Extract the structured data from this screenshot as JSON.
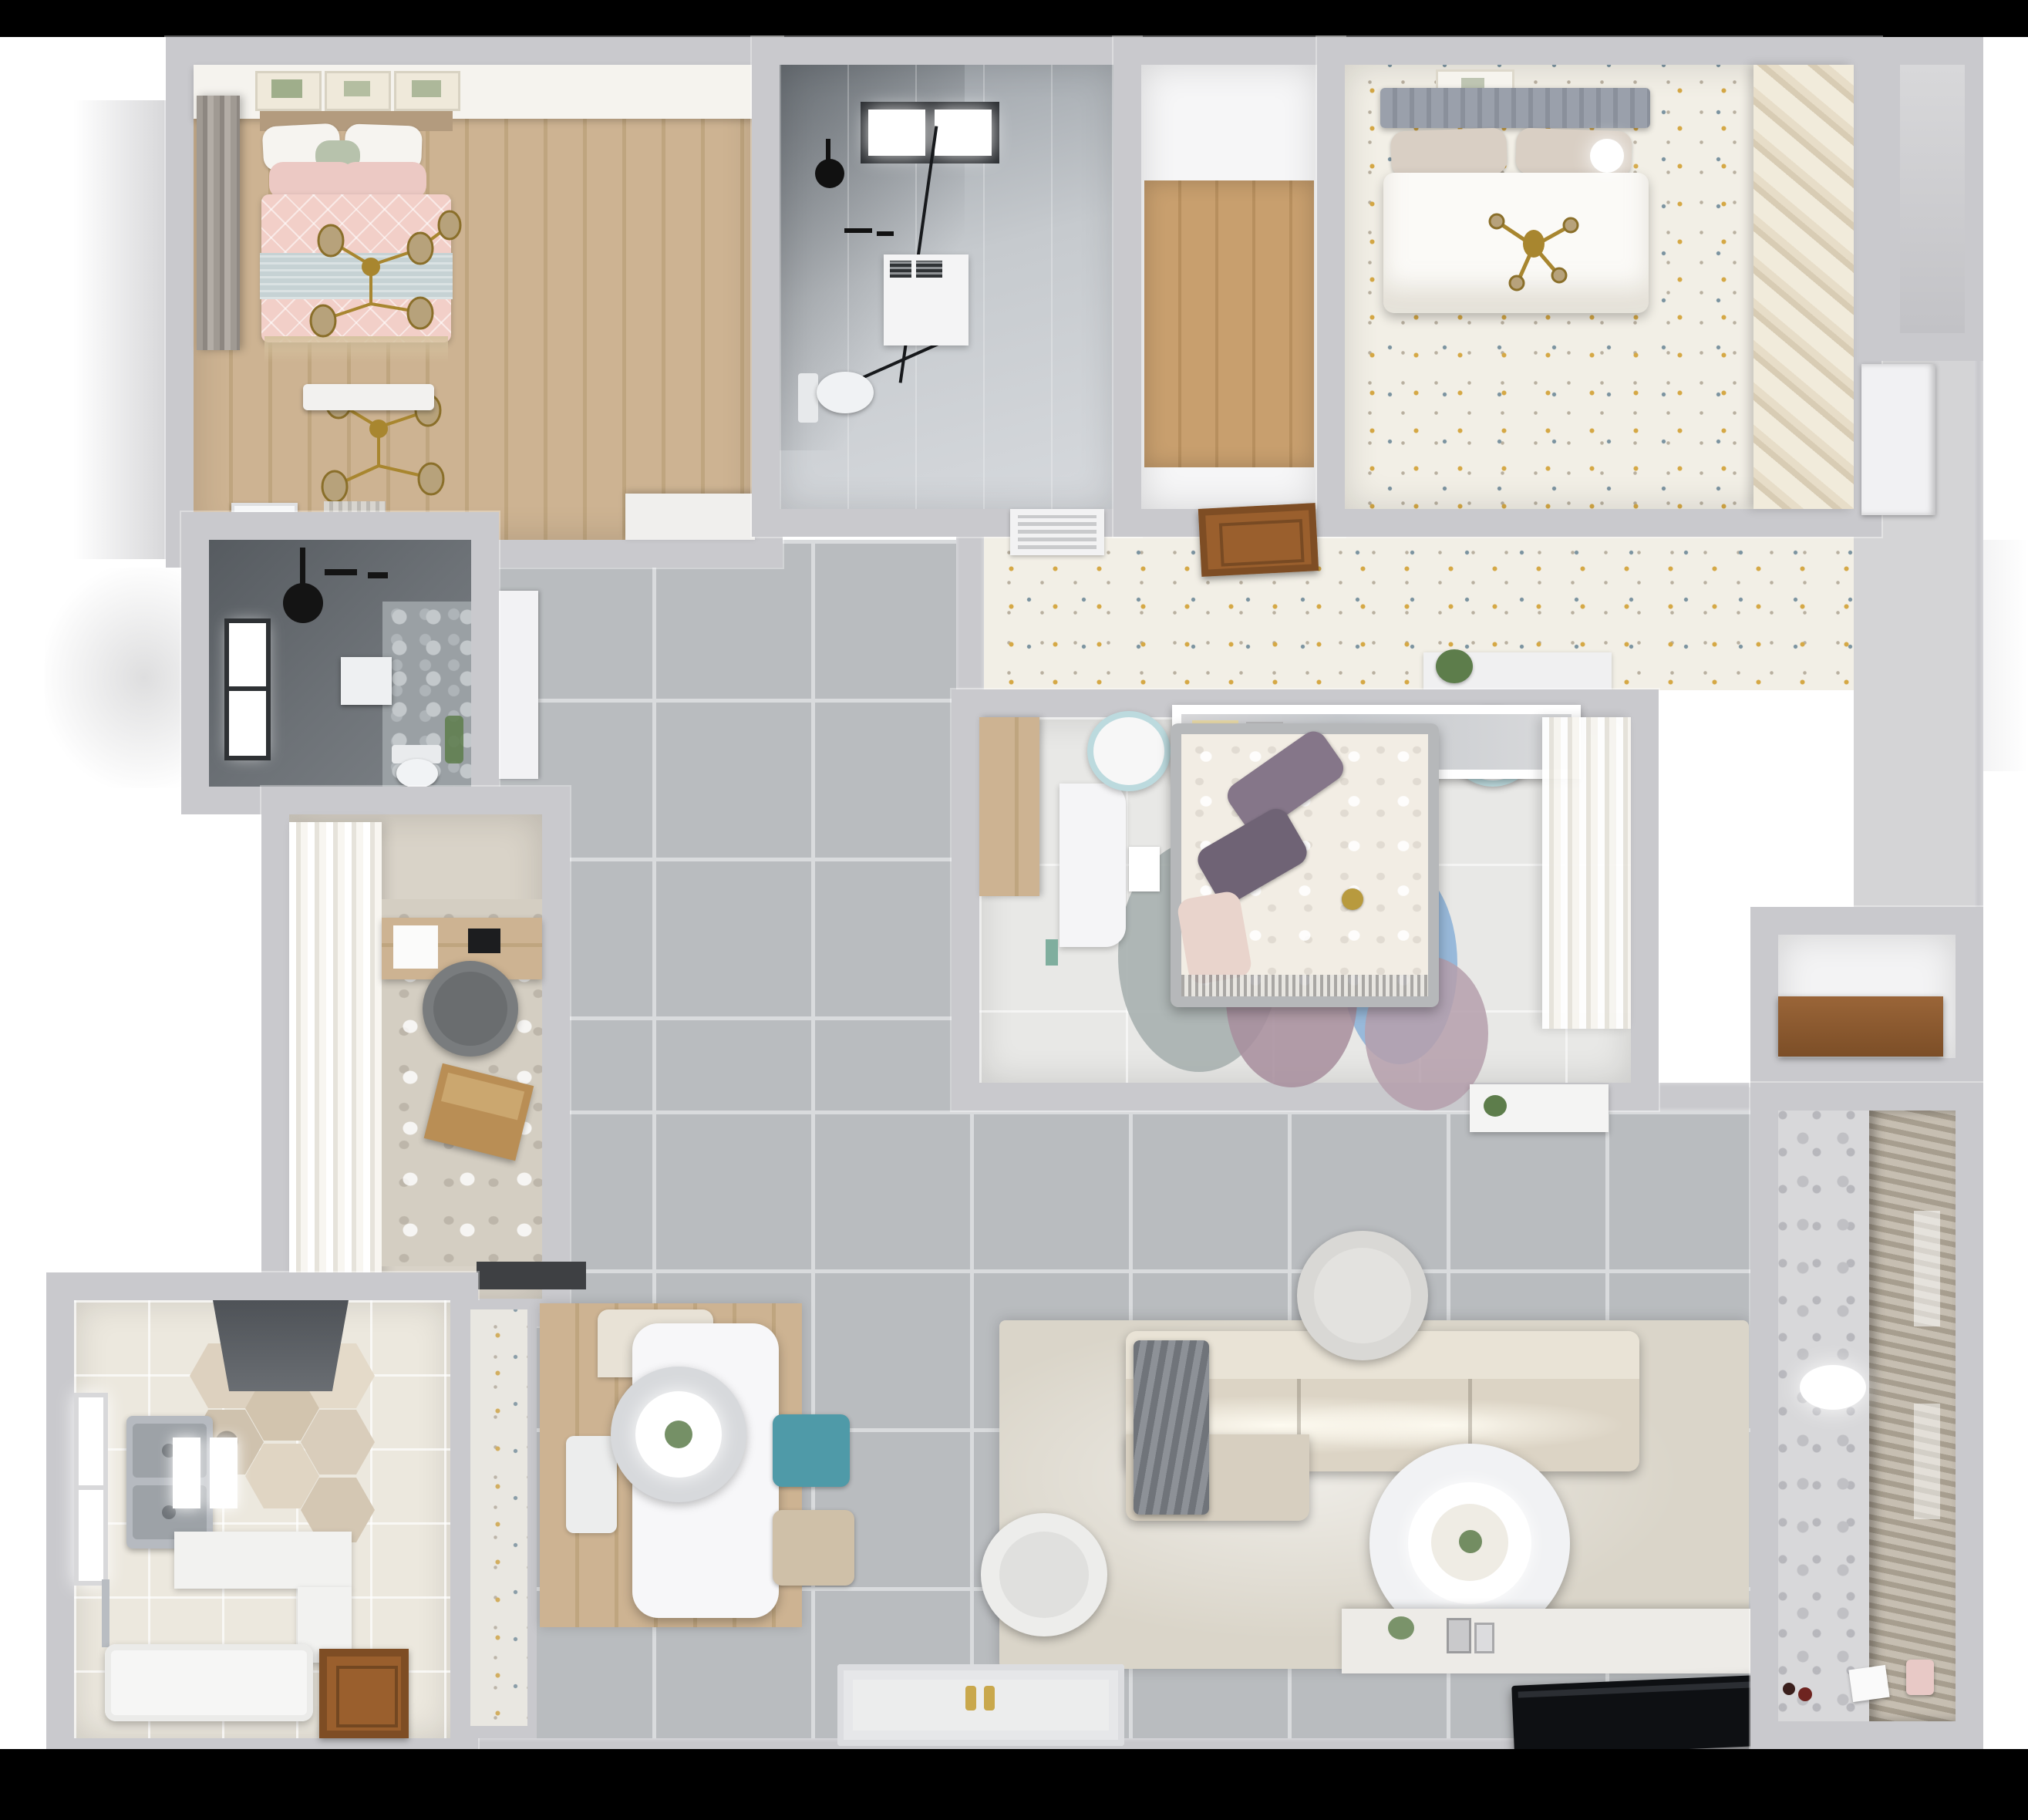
{
  "scene": {
    "title": "apartment-3d-floorplan-render",
    "description": "Top-down dollhouse 3D render of a furnished apartment with two and a half bedrooms, two bathrooms, study, kitchen, dining area, living room and balcony",
    "view": "top-down orthographic",
    "visible_text": "none"
  },
  "palette": {
    "bg": "#ffffff",
    "bar": "#000000",
    "wall": "#c9c9cd",
    "wallLight": "#eaeaec",
    "tileBase": "#b9bcbf",
    "tileLine": "#d9dbdd",
    "terrazzoBase": "#f2efe6",
    "woodA": "#cdb392",
    "woodB": "#bfa57f",
    "woodHallA": "#c89f6e",
    "woodHallB": "#b78f5e",
    "darkBath": "#6d7277",
    "studyFloor": "#d9d3c8",
    "room2Floor": "#e8e8e6",
    "kitchenFloor": "#ece8de",
    "hexTile": "#d9cdbb",
    "pinkDuvet": "#f2cfc8",
    "blueBlanket": "#c6d2d4",
    "gold": "#a8862f",
    "duvetWhite": "#fbfaf7",
    "purplePillow": "#857689",
    "teal": "#4f9aa8",
    "rugLiving": "#dad5c9",
    "sofaSeat": "#dcd4c5",
    "sofaBack": "#e9e3d6",
    "blanketGray": "#70747a",
    "rugBlue": "#8fb4d8",
    "rugMauve": "#a98f9e",
    "rugGray": "#a7b0af",
    "rugPink": "#b59fab",
    "tv": "#0e1013",
    "doorBrown": "#9a5f2d",
    "curtainWhite": "#f4f3ef",
    "plantGreen": "#5d7d4b",
    "chairGray": "#797c7e",
    "laptopWood": "#b98e55",
    "hood": "#5b5f64",
    "doormat": "#3e4043",
    "entryFloor": "#d4d4d6",
    "benchWhite": "#f2f1ef"
  },
  "rooms": [
    {
      "id": "master-bedroom",
      "label": "Master bedroom",
      "floor": "wood",
      "furniture": [
        "double bed with pink patterned duvet",
        "light blue blanket",
        "white and green pillows",
        "gold branch chandelier",
        "three botanical wall frames",
        "gray window curtain",
        "white bench",
        "dresser",
        "radiator",
        "bathroom door"
      ]
    },
    {
      "id": "ensuite-bathroom",
      "label": "Ensuite bathroom",
      "floor": "dark tile",
      "furniture": [
        "window",
        "black rain shower head",
        "flush plate",
        "stone feature panel",
        "toilet",
        "plant"
      ]
    },
    {
      "id": "study",
      "label": "Study",
      "floor": "beige tile",
      "furniture": [
        "sheer curtains",
        "wooden desk",
        "paper sheet",
        "gray round chair",
        "distressed rug",
        "wooden laptop",
        "dark doormat"
      ]
    },
    {
      "id": "kitchen",
      "label": "Kitchen",
      "floor": "hexagon tile",
      "furniture": [
        "range hood",
        "window",
        "double sink",
        "white counters",
        "white island block",
        "faucet",
        "open wooden door",
        "bright floor panels"
      ]
    },
    {
      "id": "dining",
      "label": "Dining area",
      "floor": "gray tile with wood rug",
      "furniture": [
        "white dining table",
        "round pendant lamp with plant",
        "teal chair",
        "beige chair",
        "white chairs"
      ]
    },
    {
      "id": "bathroom-2",
      "label": "Main bathroom",
      "floor": "marble",
      "furniture": [
        "black framed skylight window",
        "glass shower with black frame",
        "black shower head",
        "washer cabinet with frames",
        "toilet"
      ]
    },
    {
      "id": "hall-closet",
      "label": "Hall with wood floor",
      "floor": "wood",
      "furniture": []
    },
    {
      "id": "bedroom-3",
      "label": "Bedroom top-right",
      "floor": "white terrazzo",
      "furniture": [
        "bed with gray ribbed headboard",
        "beige pillows",
        "white duvet",
        "gold cross pendant",
        "ceiling light",
        "art frame",
        "diagonal slatted closet"
      ]
    },
    {
      "id": "corridor",
      "label": "Corridor",
      "floor": "terrazzo",
      "furniture": [
        "AC vent",
        "open brown door",
        "white console with plant"
      ]
    },
    {
      "id": "bedroom-2",
      "label": "Bedroom middle-right",
      "floor": "light marble",
      "furniture": [
        "bed with floral duvet",
        "purple pillows",
        "pink pillow",
        "round rug of overlapping circles",
        "white desk",
        "wood wardrobe",
        "white shelf with books",
        "two teal-white stools",
        "sheer closet curtains",
        "console"
      ]
    },
    {
      "id": "entry",
      "label": "Entry",
      "floor": "gray",
      "furniture": [
        "white entry door",
        "closet nook"
      ]
    },
    {
      "id": "living-room",
      "label": "Living room",
      "floor": "gray tile with beige rug",
      "furniture": [
        "sectional sofa",
        "gray blanket",
        "round pouf",
        "white armchair",
        "round double coffee table with plant",
        "TV console with decor",
        "black TV",
        "open white front door with gold handles"
      ]
    },
    {
      "id": "balcony",
      "label": "Balcony",
      "floor": "light tile",
      "furniture": [
        "patterned wall",
        "venetian blinds",
        "oval ceiling light",
        "toys",
        "papers",
        "pink bucket"
      ]
    },
    {
      "id": "alcove",
      "label": "Storage alcove",
      "floor": "white",
      "furniture": [
        "wooden shelf"
      ]
    }
  ]
}
